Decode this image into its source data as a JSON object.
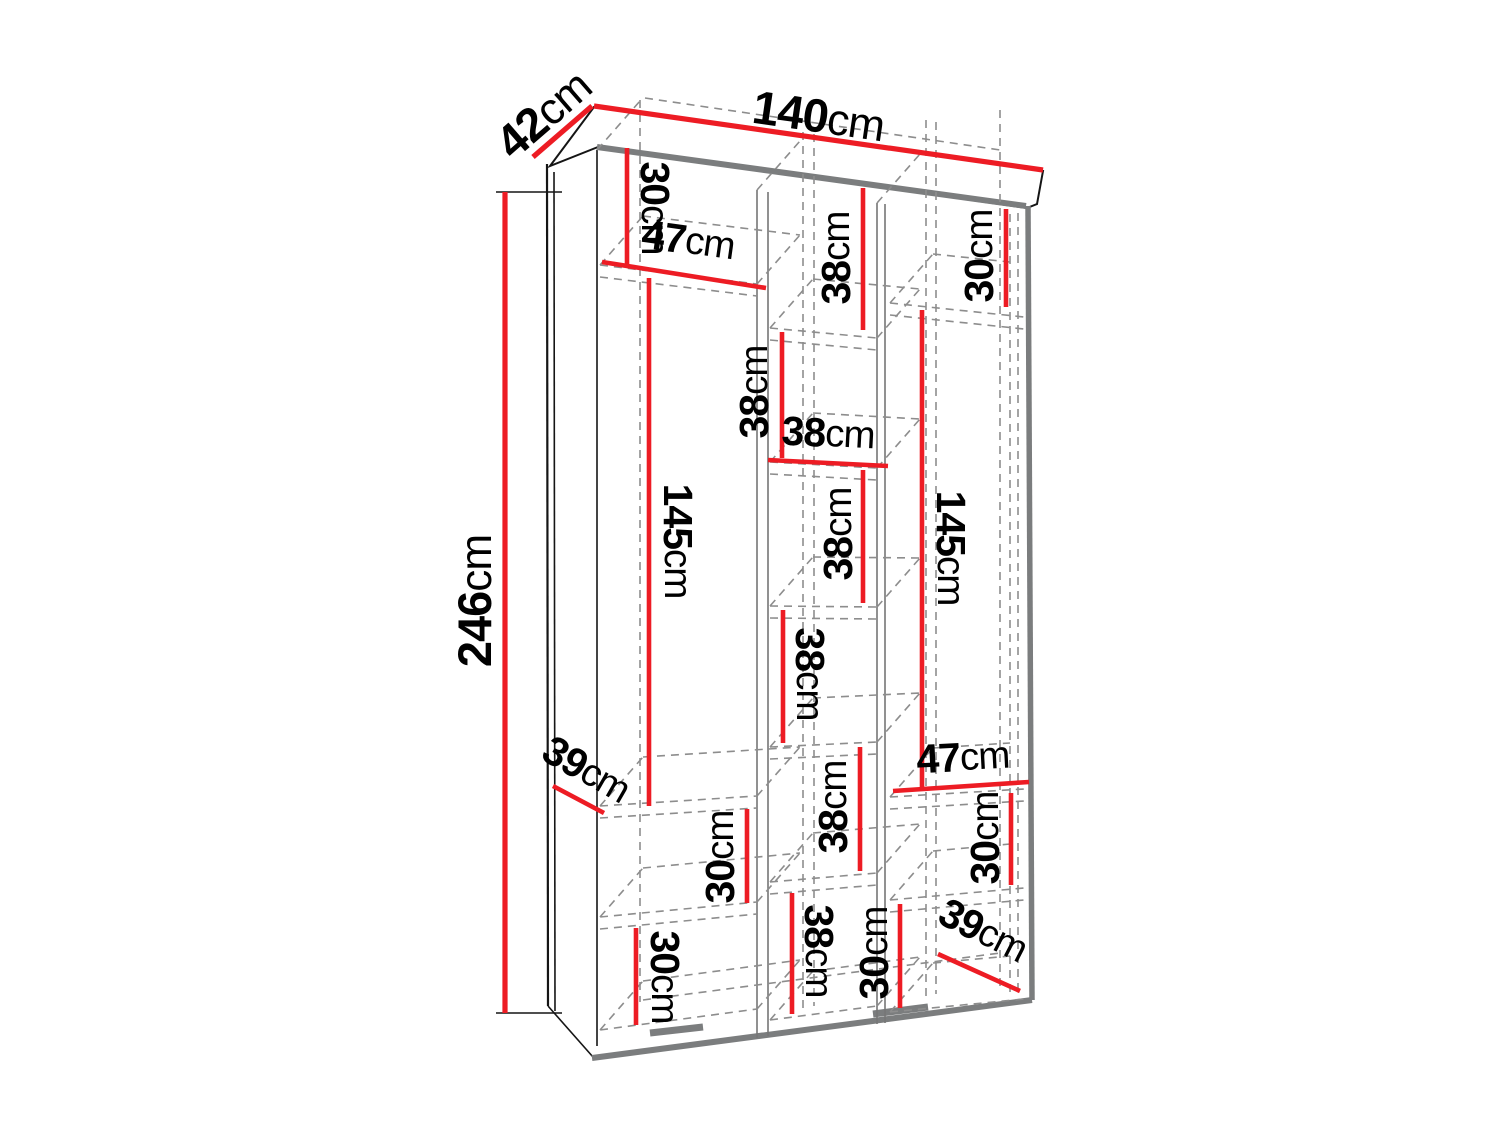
{
  "diagram": {
    "type": "furniture-dimension-drawing",
    "subject": "three-column wardrobe interior, axonometric view",
    "unit": "cm",
    "colors": {
      "dimension_red": "#ed1c24",
      "structure_gray": "#7b7d7e",
      "hidden_edge_gray": "#8d8d8d",
      "outline_black": "#151515",
      "background": "#ffffff"
    },
    "dims": [
      {
        "id": "width-top",
        "value": "140",
        "unit": "cm"
      },
      {
        "id": "depth-top",
        "value": "42",
        "unit": "cm"
      },
      {
        "id": "height-left",
        "value": "246",
        "unit": "cm"
      },
      {
        "id": "left-top-section-height",
        "value": "30",
        "unit": "cm"
      },
      {
        "id": "left-top-shelf-width",
        "value": "47",
        "unit": "cm"
      },
      {
        "id": "left-hanging-space-height",
        "value": "145",
        "unit": "cm"
      },
      {
        "id": "left-shelf-depth",
        "value": "39",
        "unit": "cm"
      },
      {
        "id": "left-lower-section-height",
        "value": "30",
        "unit": "cm"
      },
      {
        "id": "left-bottom-section-height",
        "value": "30",
        "unit": "cm"
      },
      {
        "id": "middle-cubby-1-height",
        "value": "38",
        "unit": "cm"
      },
      {
        "id": "middle-cubby-2-height",
        "value": "38",
        "unit": "cm"
      },
      {
        "id": "middle-cubby-width",
        "value": "38",
        "unit": "cm"
      },
      {
        "id": "middle-cubby-3-height",
        "value": "38",
        "unit": "cm"
      },
      {
        "id": "middle-cubby-4-height",
        "value": "38",
        "unit": "cm"
      },
      {
        "id": "middle-cubby-5-height",
        "value": "38",
        "unit": "cm"
      },
      {
        "id": "middle-cubby-6-height",
        "value": "38",
        "unit": "cm"
      },
      {
        "id": "middle-bottom-section-height",
        "value": "30",
        "unit": "cm"
      },
      {
        "id": "right-top-section-height",
        "value": "30",
        "unit": "cm"
      },
      {
        "id": "right-hanging-space-height",
        "value": "145",
        "unit": "cm"
      },
      {
        "id": "right-shelf-width",
        "value": "47",
        "unit": "cm"
      },
      {
        "id": "right-lower-section-height",
        "value": "30",
        "unit": "cm"
      },
      {
        "id": "right-shelf-depth",
        "value": "39",
        "unit": "cm"
      }
    ]
  }
}
